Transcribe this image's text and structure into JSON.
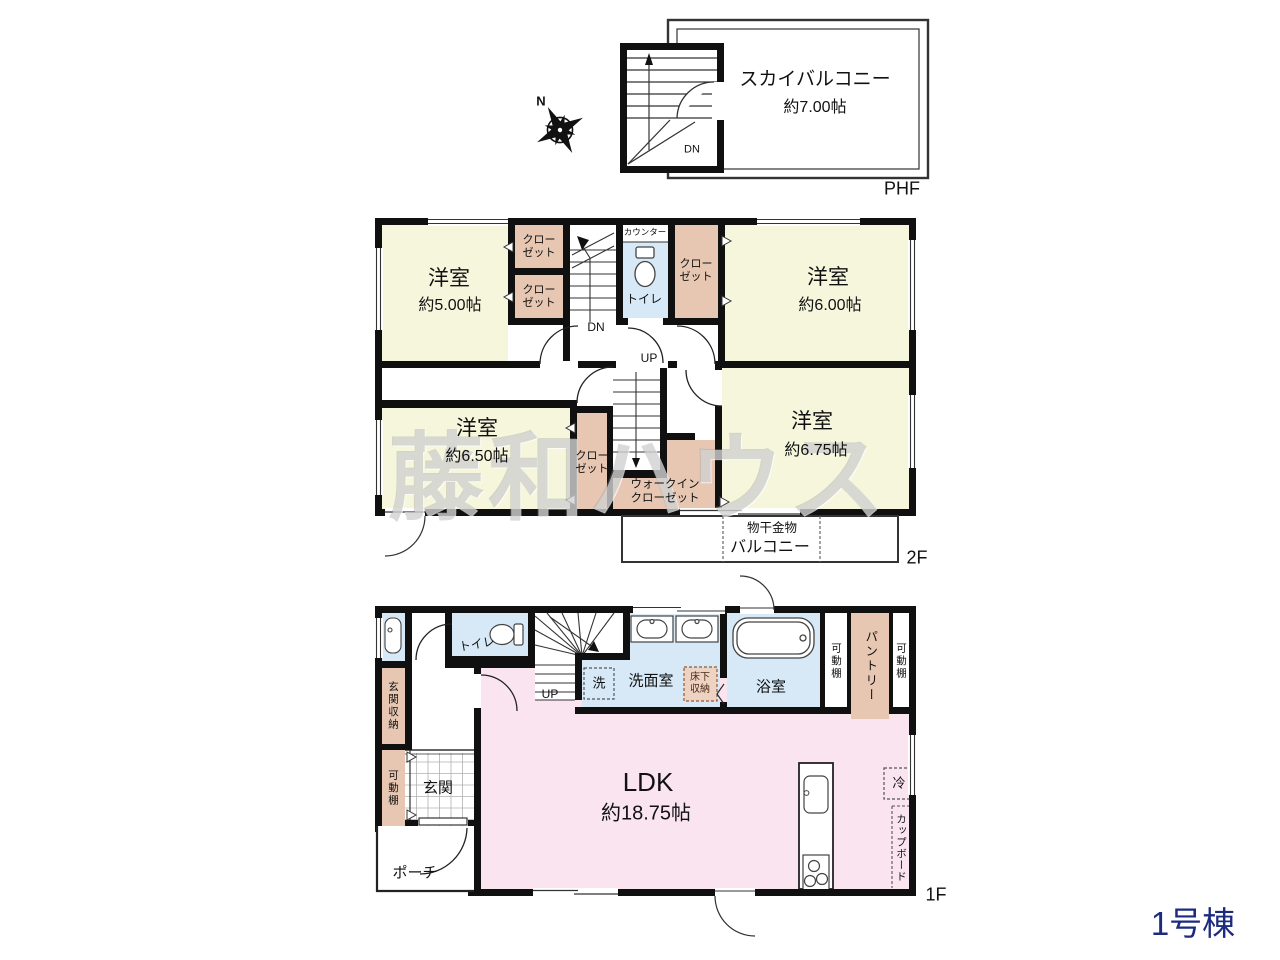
{
  "building": "1号棟",
  "watermark": "藤和ハウス",
  "compass_n": "N",
  "colors": {
    "room_yellow": "#f5f6dc",
    "closet_tan": "#e7c7b2",
    "water_blue": "#d7e9f7",
    "ldk_pink": "#f9e4ef",
    "wall_black": "#111111",
    "building_navy": "#1c2b80"
  },
  "phf": {
    "floor": "PHF",
    "balcony_name": "スカイバルコニー",
    "balcony_size": "約7.00帖",
    "dn": "DN"
  },
  "f2": {
    "floor": "2F",
    "room_nw": "洋室",
    "room_nw_size": "約5.00帖",
    "room_ne": "洋室",
    "room_ne_size": "約6.00帖",
    "room_sw": "洋室",
    "room_sw_size": "約6.50帖",
    "room_se": "洋室",
    "room_se_size": "約6.75帖",
    "closet": "クローゼット",
    "walkin": "ウォークインクローゼット",
    "counter": "カウンター",
    "toilet": "トイレ",
    "dn": "DN",
    "up": "UP",
    "monohoshi": "物干金物",
    "balcony": "バルコニー"
  },
  "f1": {
    "floor": "1F",
    "toilet": "トイレ",
    "entr_storage": "玄関収納",
    "shelf": "可動棚",
    "entrance": "玄関",
    "porch": "ポーチ",
    "up": "UP",
    "washer": "洗",
    "washroom": "洗面室",
    "underfloor": "床下収納",
    "bath": "浴室",
    "pantry": "パントリー",
    "ldk": "LDK",
    "ldk_size": "約18.75帖",
    "fridge": "冷",
    "cupboard": "カップボード"
  }
}
